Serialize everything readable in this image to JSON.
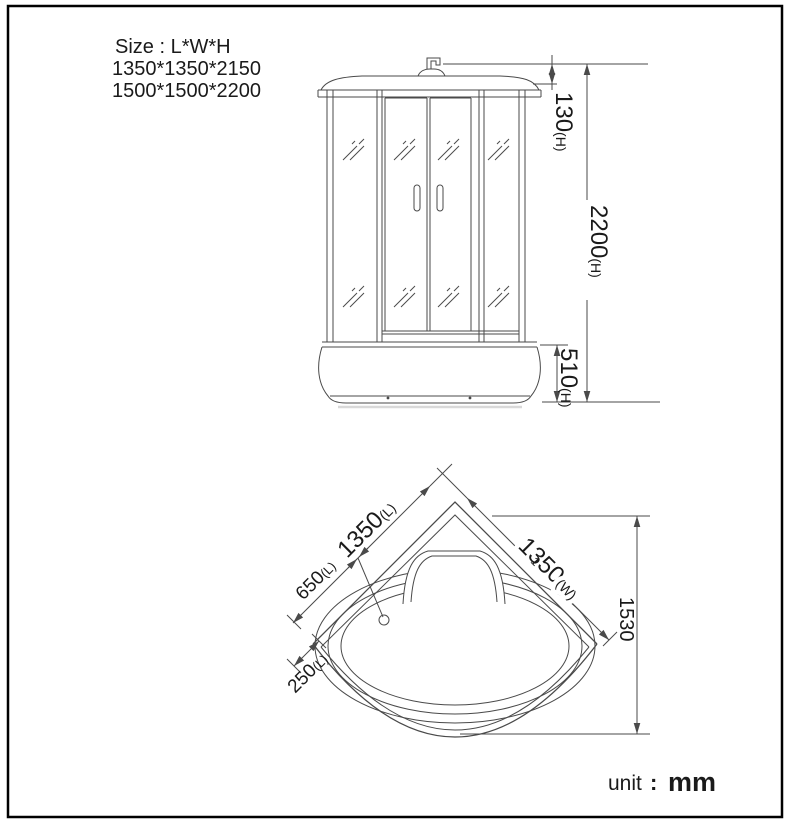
{
  "drawing": {
    "size_block": {
      "line1": "Size : L*W*H",
      "line2": "1350*1350*2150",
      "line3": "1500*1500*2200"
    },
    "front_view": {
      "dim_cap_height": {
        "value": "130",
        "suffix": "(H)"
      },
      "dim_total_height": {
        "value": "2200",
        "suffix": "(H)"
      },
      "dim_tray_height": {
        "value": "510",
        "suffix": "(H)"
      }
    },
    "plan_view": {
      "dim_length": {
        "value": "1350",
        "suffix": "(L)"
      },
      "dim_width": {
        "value": "1350",
        "suffix": "(W)"
      },
      "dim_seat_offset": {
        "value": "650",
        "suffix": "(L)"
      },
      "dim_corner_offset": {
        "value": "250",
        "suffix": "(L)"
      },
      "dim_diagonal": {
        "value": "1530"
      },
      "stray_mark": "1"
    },
    "unit_note": {
      "label": "unit",
      "colon": ":",
      "value": "mm"
    },
    "colors": {
      "line": "#4a4a4a",
      "text": "#1a1a1a",
      "border": "#000000",
      "background": "#ffffff"
    }
  }
}
